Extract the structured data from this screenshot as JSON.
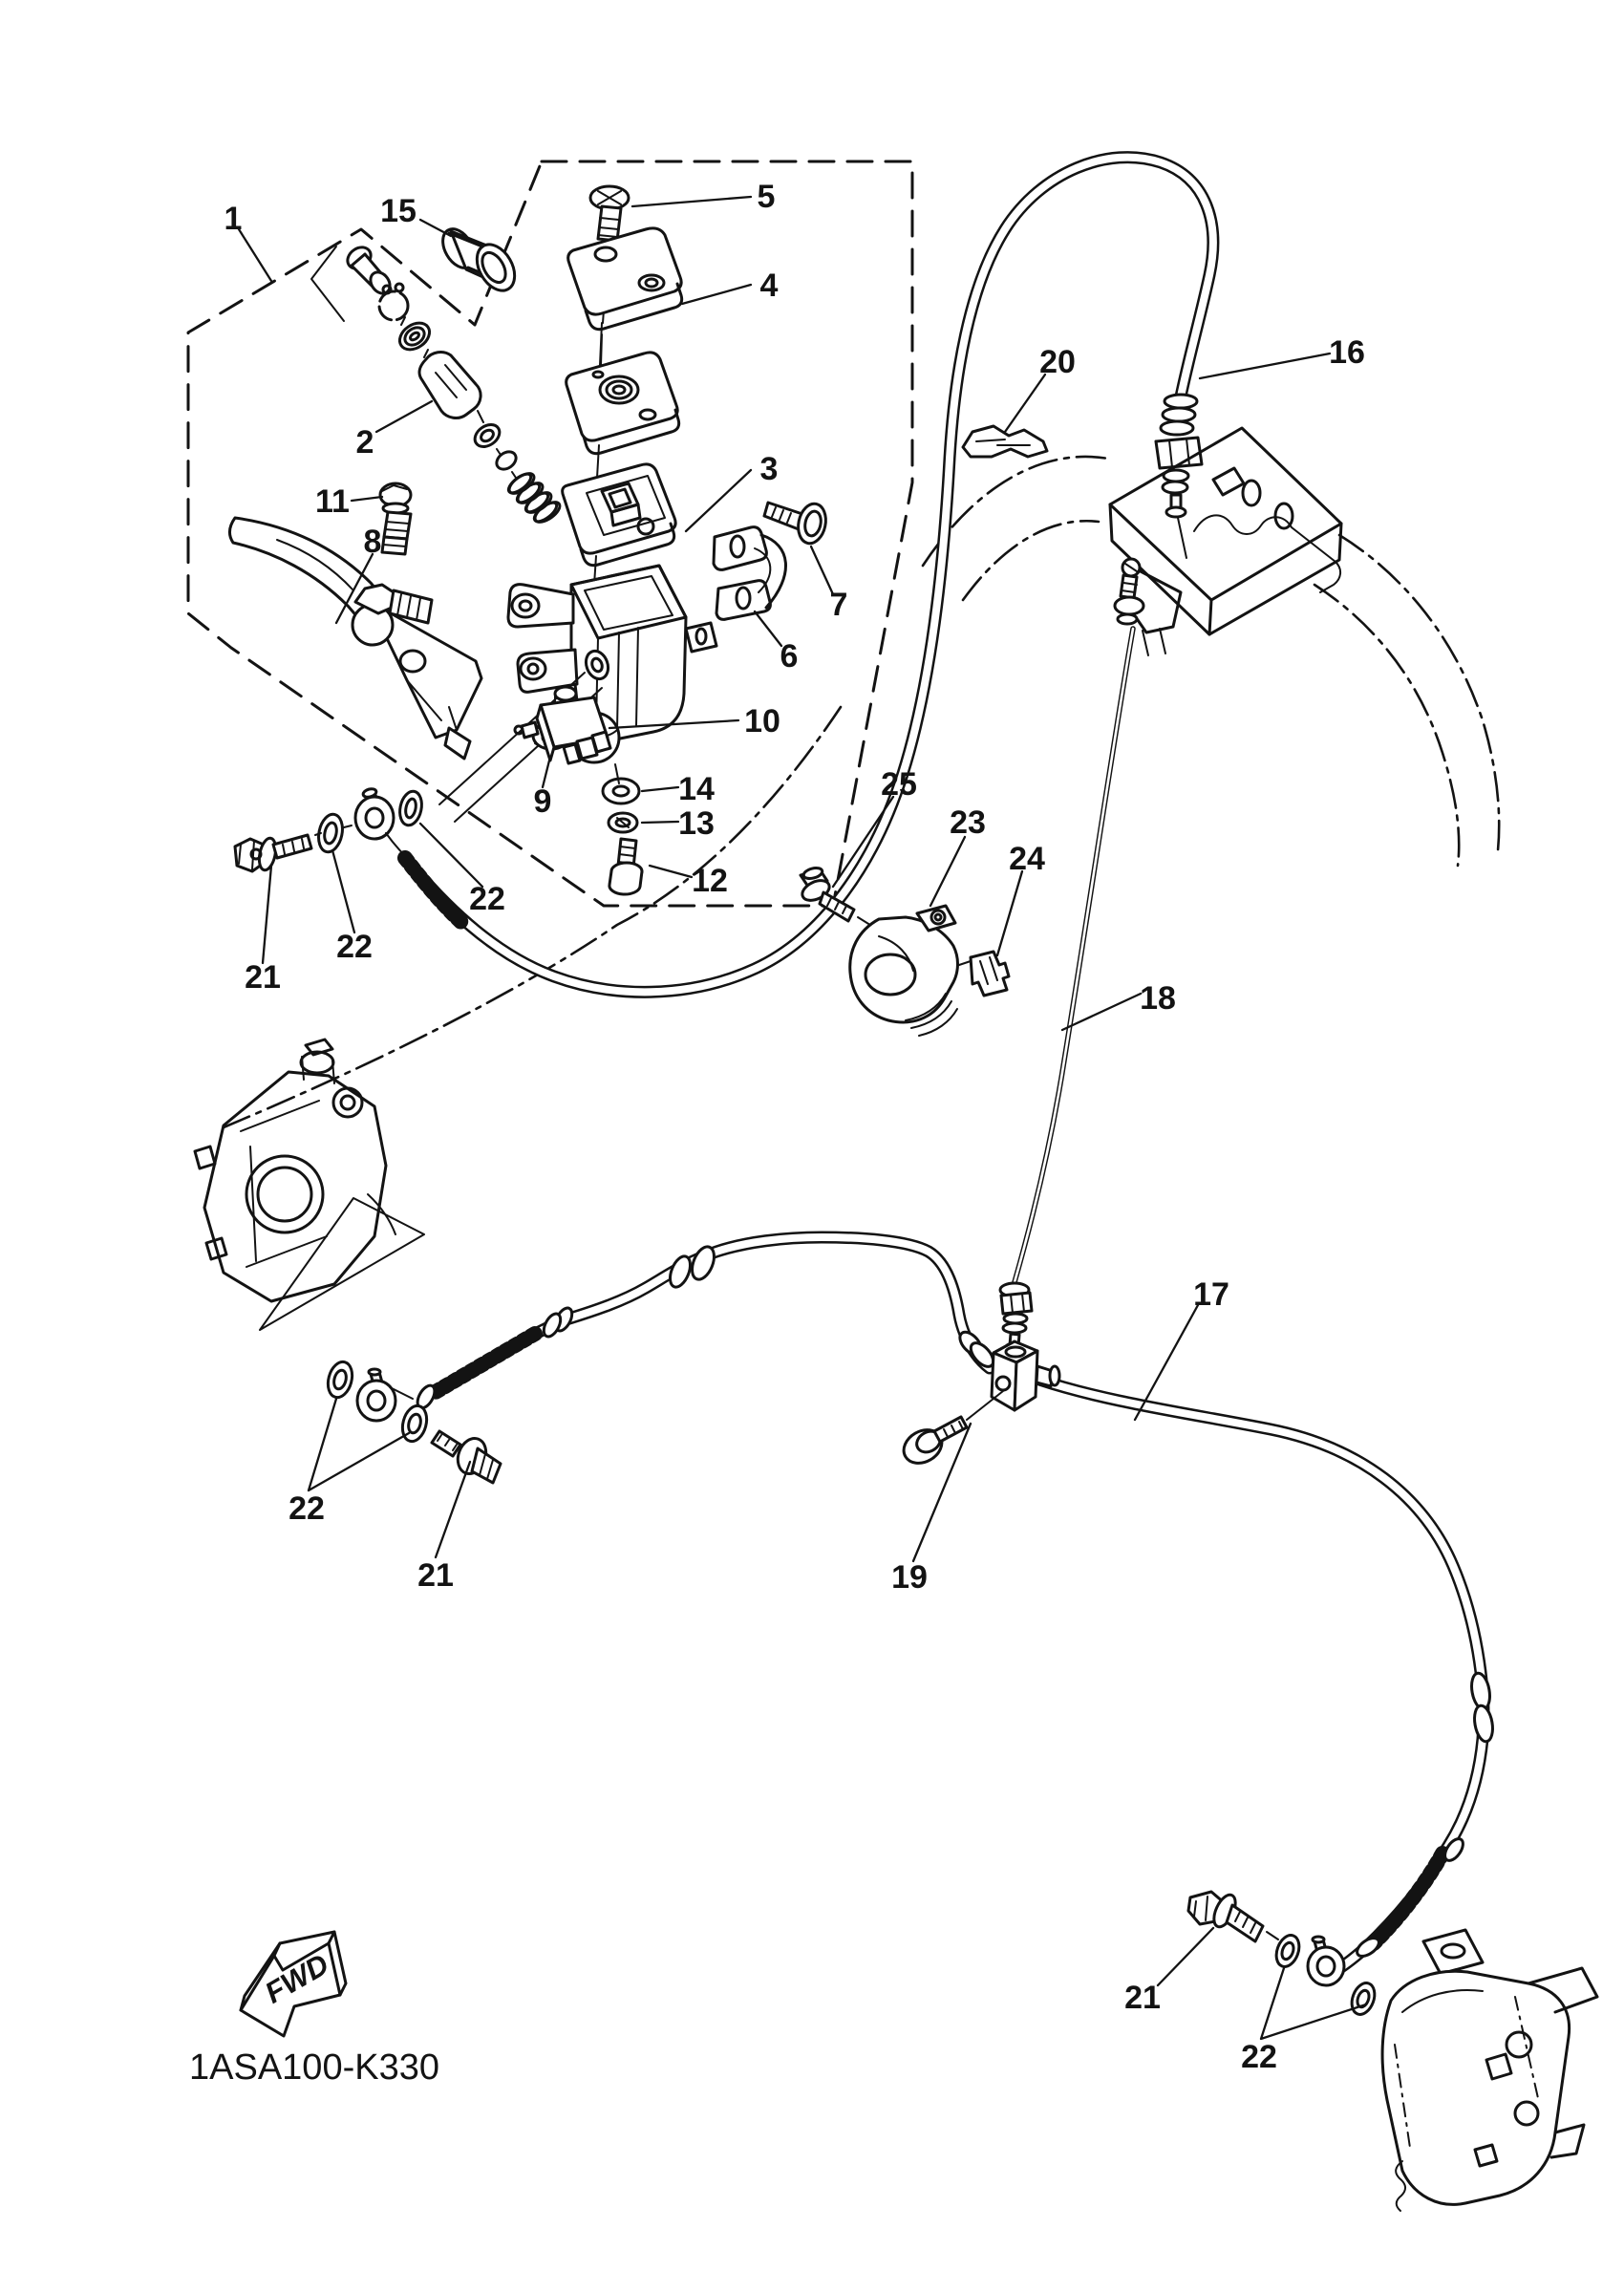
{
  "diagram": {
    "part_code": "1ASA100-K330",
    "fwd_label": "FWD",
    "colors": {
      "line": "#131313",
      "background": "#ffffff"
    },
    "callouts": [
      {
        "label": "1"
      },
      {
        "label": "15"
      },
      {
        "label": "5"
      },
      {
        "label": "4"
      },
      {
        "label": "3"
      },
      {
        "label": "2"
      },
      {
        "label": "11"
      },
      {
        "label": "8"
      },
      {
        "label": "7"
      },
      {
        "label": "6"
      },
      {
        "label": "10"
      },
      {
        "label": "14"
      },
      {
        "label": "13"
      },
      {
        "label": "12"
      },
      {
        "label": "9"
      },
      {
        "label": "22"
      },
      {
        "label": "22"
      },
      {
        "label": "21"
      },
      {
        "label": "25"
      },
      {
        "label": "23"
      },
      {
        "label": "24"
      },
      {
        "label": "18"
      },
      {
        "label": "16"
      },
      {
        "label": "20"
      },
      {
        "label": "17"
      },
      {
        "label": "19"
      },
      {
        "label": "22"
      },
      {
        "label": "21"
      },
      {
        "label": "21"
      },
      {
        "label": "22"
      }
    ]
  }
}
